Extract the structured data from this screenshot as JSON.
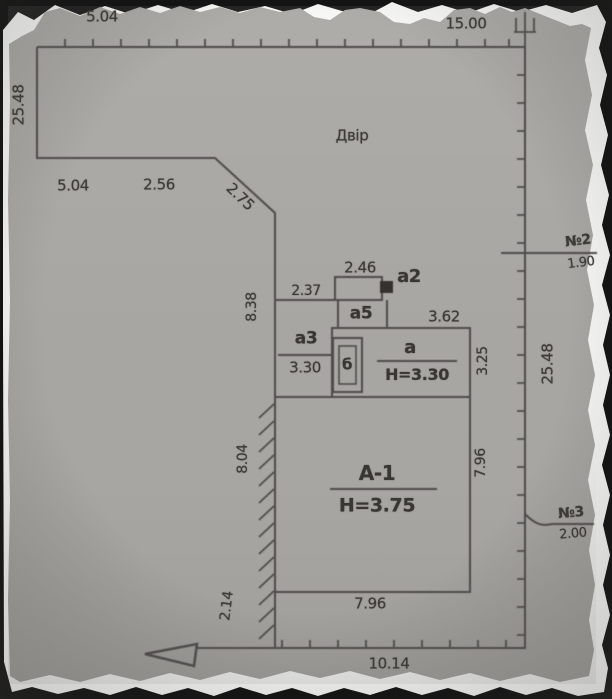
{
  "plan": {
    "yard_label": "Двір",
    "buildings": {
      "a1": {
        "label": "А-1",
        "height": "Н=3.75"
      },
      "a": {
        "label": "а",
        "height": "Н=3.30"
      },
      "a2": {
        "label": "а2"
      },
      "a3": {
        "label": "а3",
        "value": "3.30"
      },
      "a5": {
        "label": "а5"
      },
      "b": {
        "label": "б"
      }
    },
    "points": {
      "p2": {
        "label": "№2",
        "value": "1.90"
      },
      "p3": {
        "label": "№3",
        "value": "2.00"
      }
    },
    "dimensions": {
      "top_left": "5.04",
      "top_right": "15.00",
      "left_upper": "25.48",
      "step_w1": "5.04",
      "step_w2": "2.56",
      "diagonal": "2.75",
      "left_mid": "8.38",
      "annex_offset": "2.37",
      "a2_width": "2.46",
      "a_width": "3.62",
      "a_right_side": "3.25",
      "right_boundary": "25.48",
      "a1_left_side": "8.04",
      "a1_right_side": "7.96",
      "a1_bottom": "7.96",
      "left_lower": "2.14",
      "bottom": "10.14"
    },
    "colors": {
      "paper": "#a8a6a2",
      "line": "#4e4c49",
      "text": "#3d3b38",
      "torn_edge": "#f6f6f4",
      "backdrop": "#141414"
    }
  }
}
